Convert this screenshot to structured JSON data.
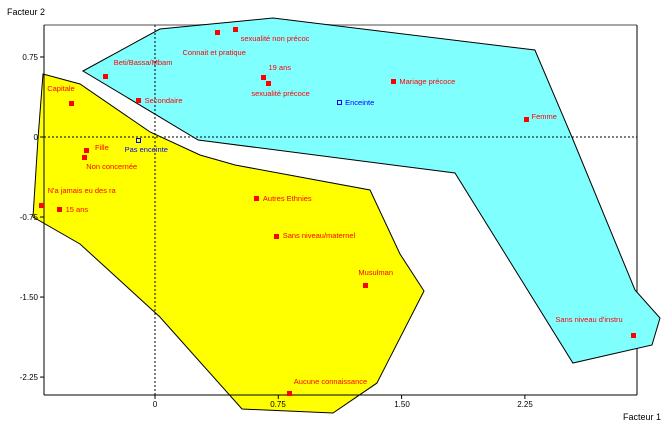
{
  "chart_data": {
    "type": "scatter",
    "title": "",
    "xlabel": "Facteur 1",
    "ylabel": "Facteur 2",
    "xlim": [
      -0.67,
      2.93
    ],
    "ylim": [
      -2.42,
      1.05
    ],
    "grid": "dashed-zero-lines",
    "legend": "none",
    "x_ticks": [
      {
        "v": 0,
        "label": "0"
      },
      {
        "v": 0.75,
        "label": "0.75"
      },
      {
        "v": 1.5,
        "label": "1.50"
      },
      {
        "v": 2.25,
        "label": "2.25"
      }
    ],
    "y_ticks": [
      {
        "v": 0.75,
        "label": "0.75"
      },
      {
        "v": 0,
        "label": "0"
      },
      {
        "v": -0.75,
        "label": "-0.75"
      },
      {
        "v": -1.5,
        "label": "-1.50"
      },
      {
        "v": -2.25,
        "label": "-2.25"
      }
    ],
    "colors": {
      "active_marker": "#FF0000",
      "illustrative_marker": "#0000FF",
      "hull_upper_right": "#80FFFF",
      "hull_lower_left": "#FFFF00",
      "hull_edge": "#000000",
      "axis": "#000000",
      "top_border": "#A6A6A6",
      "background": "#FFFFFF"
    },
    "regions": [
      {
        "name": "upper-right-hull",
        "fill": "#80FFFF",
        "points_f": [
          [
            -0.438,
            0.619
          ],
          [
            0.03,
            1.012
          ],
          [
            0.718,
            1.115
          ],
          [
            2.311,
            0.815
          ],
          [
            2.536,
            0
          ],
          [
            2.92,
            -1.434
          ],
          [
            3.072,
            -1.696
          ],
          [
            3.023,
            -1.949
          ],
          [
            2.542,
            -2.118
          ],
          [
            1.825,
            -0.337
          ],
          [
            0.262,
            -0.028
          ]
        ]
      },
      {
        "name": "lower-left-hull",
        "fill": "#FFFF00",
        "points_f": [
          [
            -0.681,
            0.59
          ],
          [
            -0.456,
            0.497
          ],
          [
            -0.03,
            0.047
          ],
          [
            0.274,
            -0.169
          ],
          [
            0.487,
            -0.262
          ],
          [
            1.308,
            -0.497
          ],
          [
            1.49,
            -1.097
          ],
          [
            1.636,
            -1.443
          ],
          [
            1.35,
            -2.306
          ],
          [
            1.083,
            -2.587
          ],
          [
            0.529,
            -2.549
          ],
          [
            0.03,
            -1.687
          ],
          [
            -0.456,
            -1.003
          ],
          [
            -0.742,
            -0.75
          ],
          [
            -0.712,
            -0.028
          ]
        ]
      }
    ],
    "points": [
      {
        "label": "Connait et pratique",
        "f1": 0.38,
        "f2": 0.98,
        "marker": "square",
        "color": "#FF0000",
        "dx": -35,
        "dy": 17
      },
      {
        "label": "sexualité non précoc",
        "f1": 0.49,
        "f2": 1.01,
        "marker": "square",
        "color": "#FF0000",
        "dx": 5,
        "dy": 6
      },
      {
        "label": "Beti/Bassa/Mbam",
        "f1": -0.3,
        "f2": 0.57,
        "marker": "square",
        "color": "#FF0000",
        "dx": 8,
        "dy": -17
      },
      {
        "label": "19 ans",
        "f1": 0.66,
        "f2": 0.56,
        "marker": "square",
        "color": "#FF0000",
        "dx": 5,
        "dy": -13
      },
      {
        "label": "sexualité précoce",
        "f1": 0.69,
        "f2": 0.5,
        "marker": "square",
        "color": "#FF0000",
        "dx": -17,
        "dy": 6
      },
      {
        "label": "Mariage précoce",
        "f1": 1.45,
        "f2": 0.52,
        "marker": "square",
        "color": "#FF0000",
        "dx": 6,
        "dy": -4
      },
      {
        "label": "Capitale",
        "f1": -0.51,
        "f2": 0.31,
        "marker": "square",
        "color": "#FF0000",
        "dx": -24,
        "dy": -19
      },
      {
        "label": "Secondaire",
        "f1": -0.1,
        "f2": 0.34,
        "marker": "square",
        "color": "#FF0000",
        "dx": 6,
        "dy": -4
      },
      {
        "label": "Enceinte",
        "f1": 1.12,
        "f2": 0.32,
        "marker": "open-square",
        "color": "#0000FF",
        "dx": 6,
        "dy": -4
      },
      {
        "label": "Femme",
        "f1": 2.26,
        "f2": 0.16,
        "marker": "square",
        "color": "#FF0000",
        "dx": 5,
        "dy": -7
      },
      {
        "label": "Pas enceinte",
        "f1": -0.1,
        "f2": -0.03,
        "marker": "open-square",
        "color": "#0000FF",
        "dx": -14,
        "dy": 6
      },
      {
        "label": "Fille",
        "f1": -0.42,
        "f2": -0.13,
        "marker": "square",
        "color": "#FF0000",
        "dx": 9,
        "dy": -7
      },
      {
        "label": "Non concernée",
        "f1": -0.43,
        "f2": -0.19,
        "marker": "square",
        "color": "#FF0000",
        "dx": 2,
        "dy": 6
      },
      {
        "label": "N'a jamais eu des ra",
        "f1": -0.69,
        "f2": -0.64,
        "marker": "square",
        "color": "#FF0000",
        "dx": 6,
        "dy": -18
      },
      {
        "label": "15 ans",
        "f1": -0.58,
        "f2": -0.68,
        "marker": "square",
        "color": "#FF0000",
        "dx": 6,
        "dy": -4
      },
      {
        "label": "Autres Ethnies",
        "f1": 0.62,
        "f2": -0.58,
        "marker": "square",
        "color": "#FF0000",
        "dx": 6,
        "dy": -4
      },
      {
        "label": "Sans niveau/maternel",
        "f1": 0.74,
        "f2": -0.93,
        "marker": "square",
        "color": "#FF0000",
        "dx": 6,
        "dy": -4
      },
      {
        "label": "Musulman",
        "f1": 1.28,
        "f2": -1.39,
        "marker": "square",
        "color": "#FF0000",
        "dx": -7,
        "dy": -16
      },
      {
        "label": "Aucune connaissance",
        "f1": 0.82,
        "f2": -2.4,
        "marker": "square",
        "color": "#FF0000",
        "dx": 4,
        "dy": -15
      },
      {
        "label": "Sans niveau d'instru",
        "f1": 2.91,
        "f2": -1.86,
        "marker": "square",
        "color": "#FF0000",
        "dx": -78,
        "dy": -20
      }
    ]
  }
}
